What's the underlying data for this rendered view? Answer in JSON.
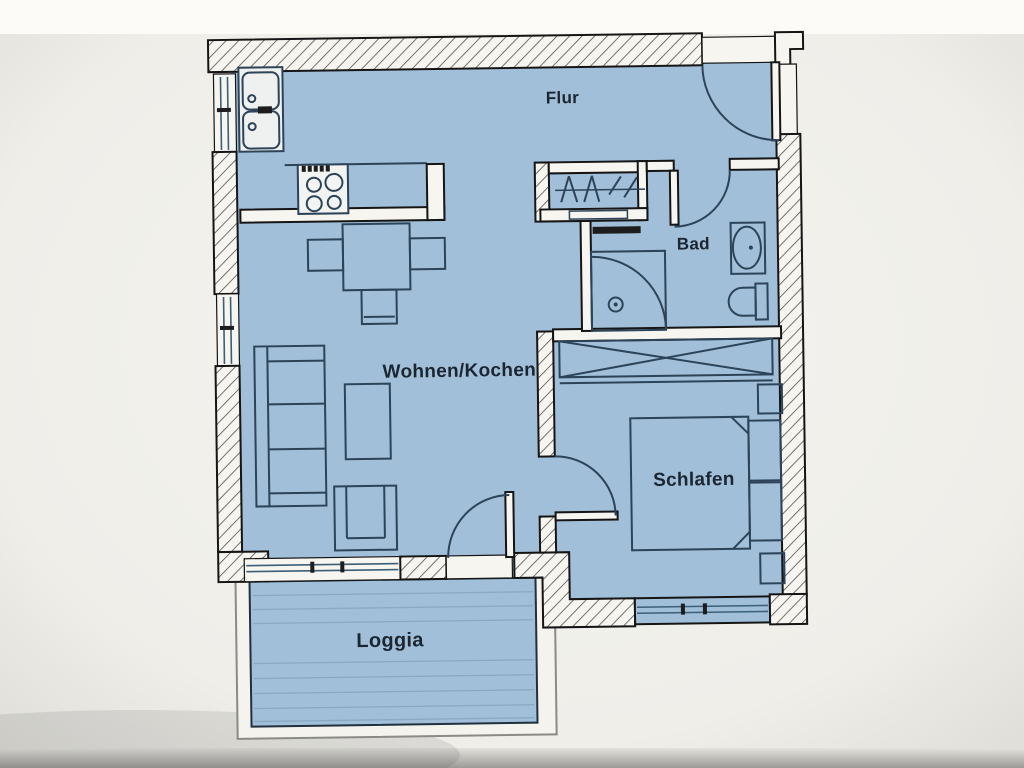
{
  "plan": {
    "rooms": {
      "flur": "Flur",
      "bad": "Bad",
      "wohnen_kochen": "Wohnen/Kochen",
      "schlafen": "Schlafen",
      "loggia": "Loggia"
    },
    "colors": {
      "floor": "#a1bfd9",
      "wall_fill": "#f6f5f0",
      "wall_line": "#151515",
      "furniture_line": "#2c4358",
      "window_line": "#3c5f78",
      "paper": "#f0efe9",
      "photo_edge": "#9b9a96"
    },
    "fixtures": {
      "kitchen": [
        "double-sink",
        "stove-4-burners",
        "kitchen-counter"
      ],
      "dining": [
        "dining-table",
        "chair-left",
        "chair-right",
        "chair-bottom"
      ],
      "living": [
        "sofa",
        "coffee-table",
        "armchair"
      ],
      "hall": [
        "wardrobe-with-hangers"
      ],
      "bathroom": [
        "corner-shower",
        "washbasin",
        "toilet"
      ],
      "bedroom": [
        "built-in-closet",
        "double-bed",
        "nightstand-top",
        "nightstand-bottom"
      ]
    },
    "doors": [
      "entrance-door",
      "bathroom-door",
      "bedroom-door",
      "balcony-door"
    ],
    "windows": [
      "kitchen-window",
      "living-window-left",
      "living-window-south",
      "bedroom-window"
    ]
  }
}
